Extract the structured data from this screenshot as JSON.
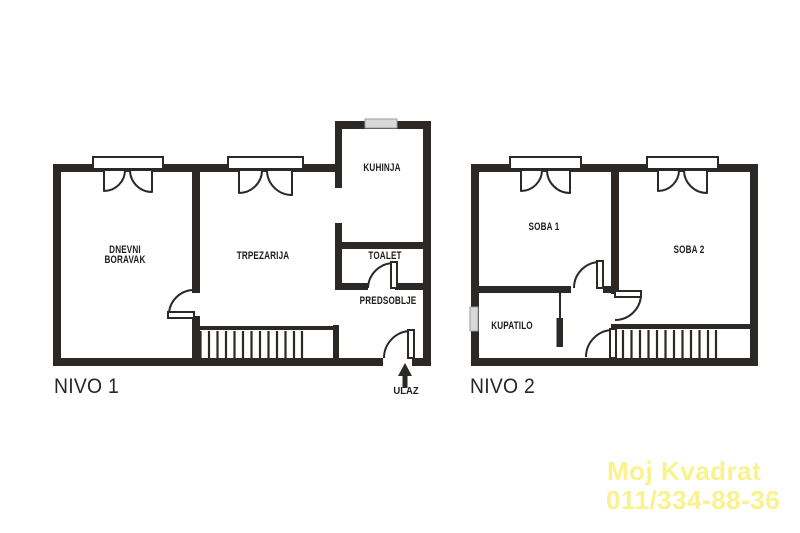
{
  "watermark": {
    "line1": "Moj Kvadrat",
    "line2": "011/334-88-36",
    "color": "#FAF28C"
  },
  "colors": {
    "wall": "#2B2825",
    "label": "#1D1C1A",
    "glass": "#D8D8D8"
  },
  "levels": [
    {
      "name": "NIVO 1",
      "rooms": [
        {
          "id": "dnevni-boravak",
          "label": "DNEVNI\nBORAVAK"
        },
        {
          "id": "trpezarija",
          "label": "TRPEZARIJA"
        },
        {
          "id": "kuhinja",
          "label": "KUHINJA"
        },
        {
          "id": "toalet",
          "label": "TOALET"
        },
        {
          "id": "predsoblje",
          "label": "PREDSOBLJE"
        }
      ],
      "entrance_label": "ULAZ"
    },
    {
      "name": "NIVO 2",
      "rooms": [
        {
          "id": "soba-1",
          "label": "SOBA 1"
        },
        {
          "id": "soba-2",
          "label": "SOBA 2"
        },
        {
          "id": "kupatilo",
          "label": "KUPATILO"
        }
      ]
    }
  ]
}
